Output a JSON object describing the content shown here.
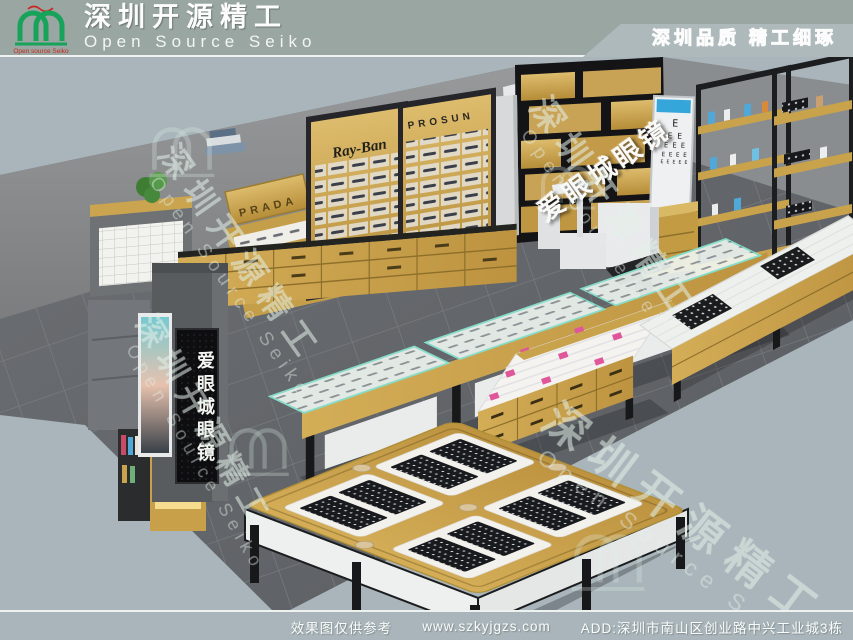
{
  "header": {
    "brand_cn": "深圳开源精工",
    "brand_en": "Open Source Seiko",
    "logo_caption": "Open source Seiko",
    "tagline": "深圳品质 精工细琢"
  },
  "scene": {
    "wall_sign": "爱眼城眼镜",
    "pillar_sign": "爱眼城眼镜",
    "brands": {
      "prada": "PRADA",
      "rayban": "Ray-Ban",
      "prosun": "PROSUN"
    },
    "eye_chart": {
      "rows": [
        "E",
        "E E",
        "E E E",
        "E E E E",
        "E E E E E"
      ]
    },
    "watermark": {
      "cn": "深圳开源精工",
      "en": "Open Source Seiko"
    }
  },
  "footer": {
    "disclaimer": "效果图仅供参考",
    "website": "www.szkyjgzs.com",
    "address": "ADD:深圳市南山区创业路中兴工业城3栋"
  },
  "colors": {
    "background": "#a8b4b9",
    "header_bg": "#9aa6a2",
    "wood": "#c9a24c",
    "black_wall": "#141417",
    "floor": "#67696d",
    "glass_edge": "#86dcc8",
    "accent_pink": "#e0569a",
    "logo_green": "#18a35b",
    "logo_red": "#c8281f",
    "chart_blue": "#35a6d9"
  }
}
